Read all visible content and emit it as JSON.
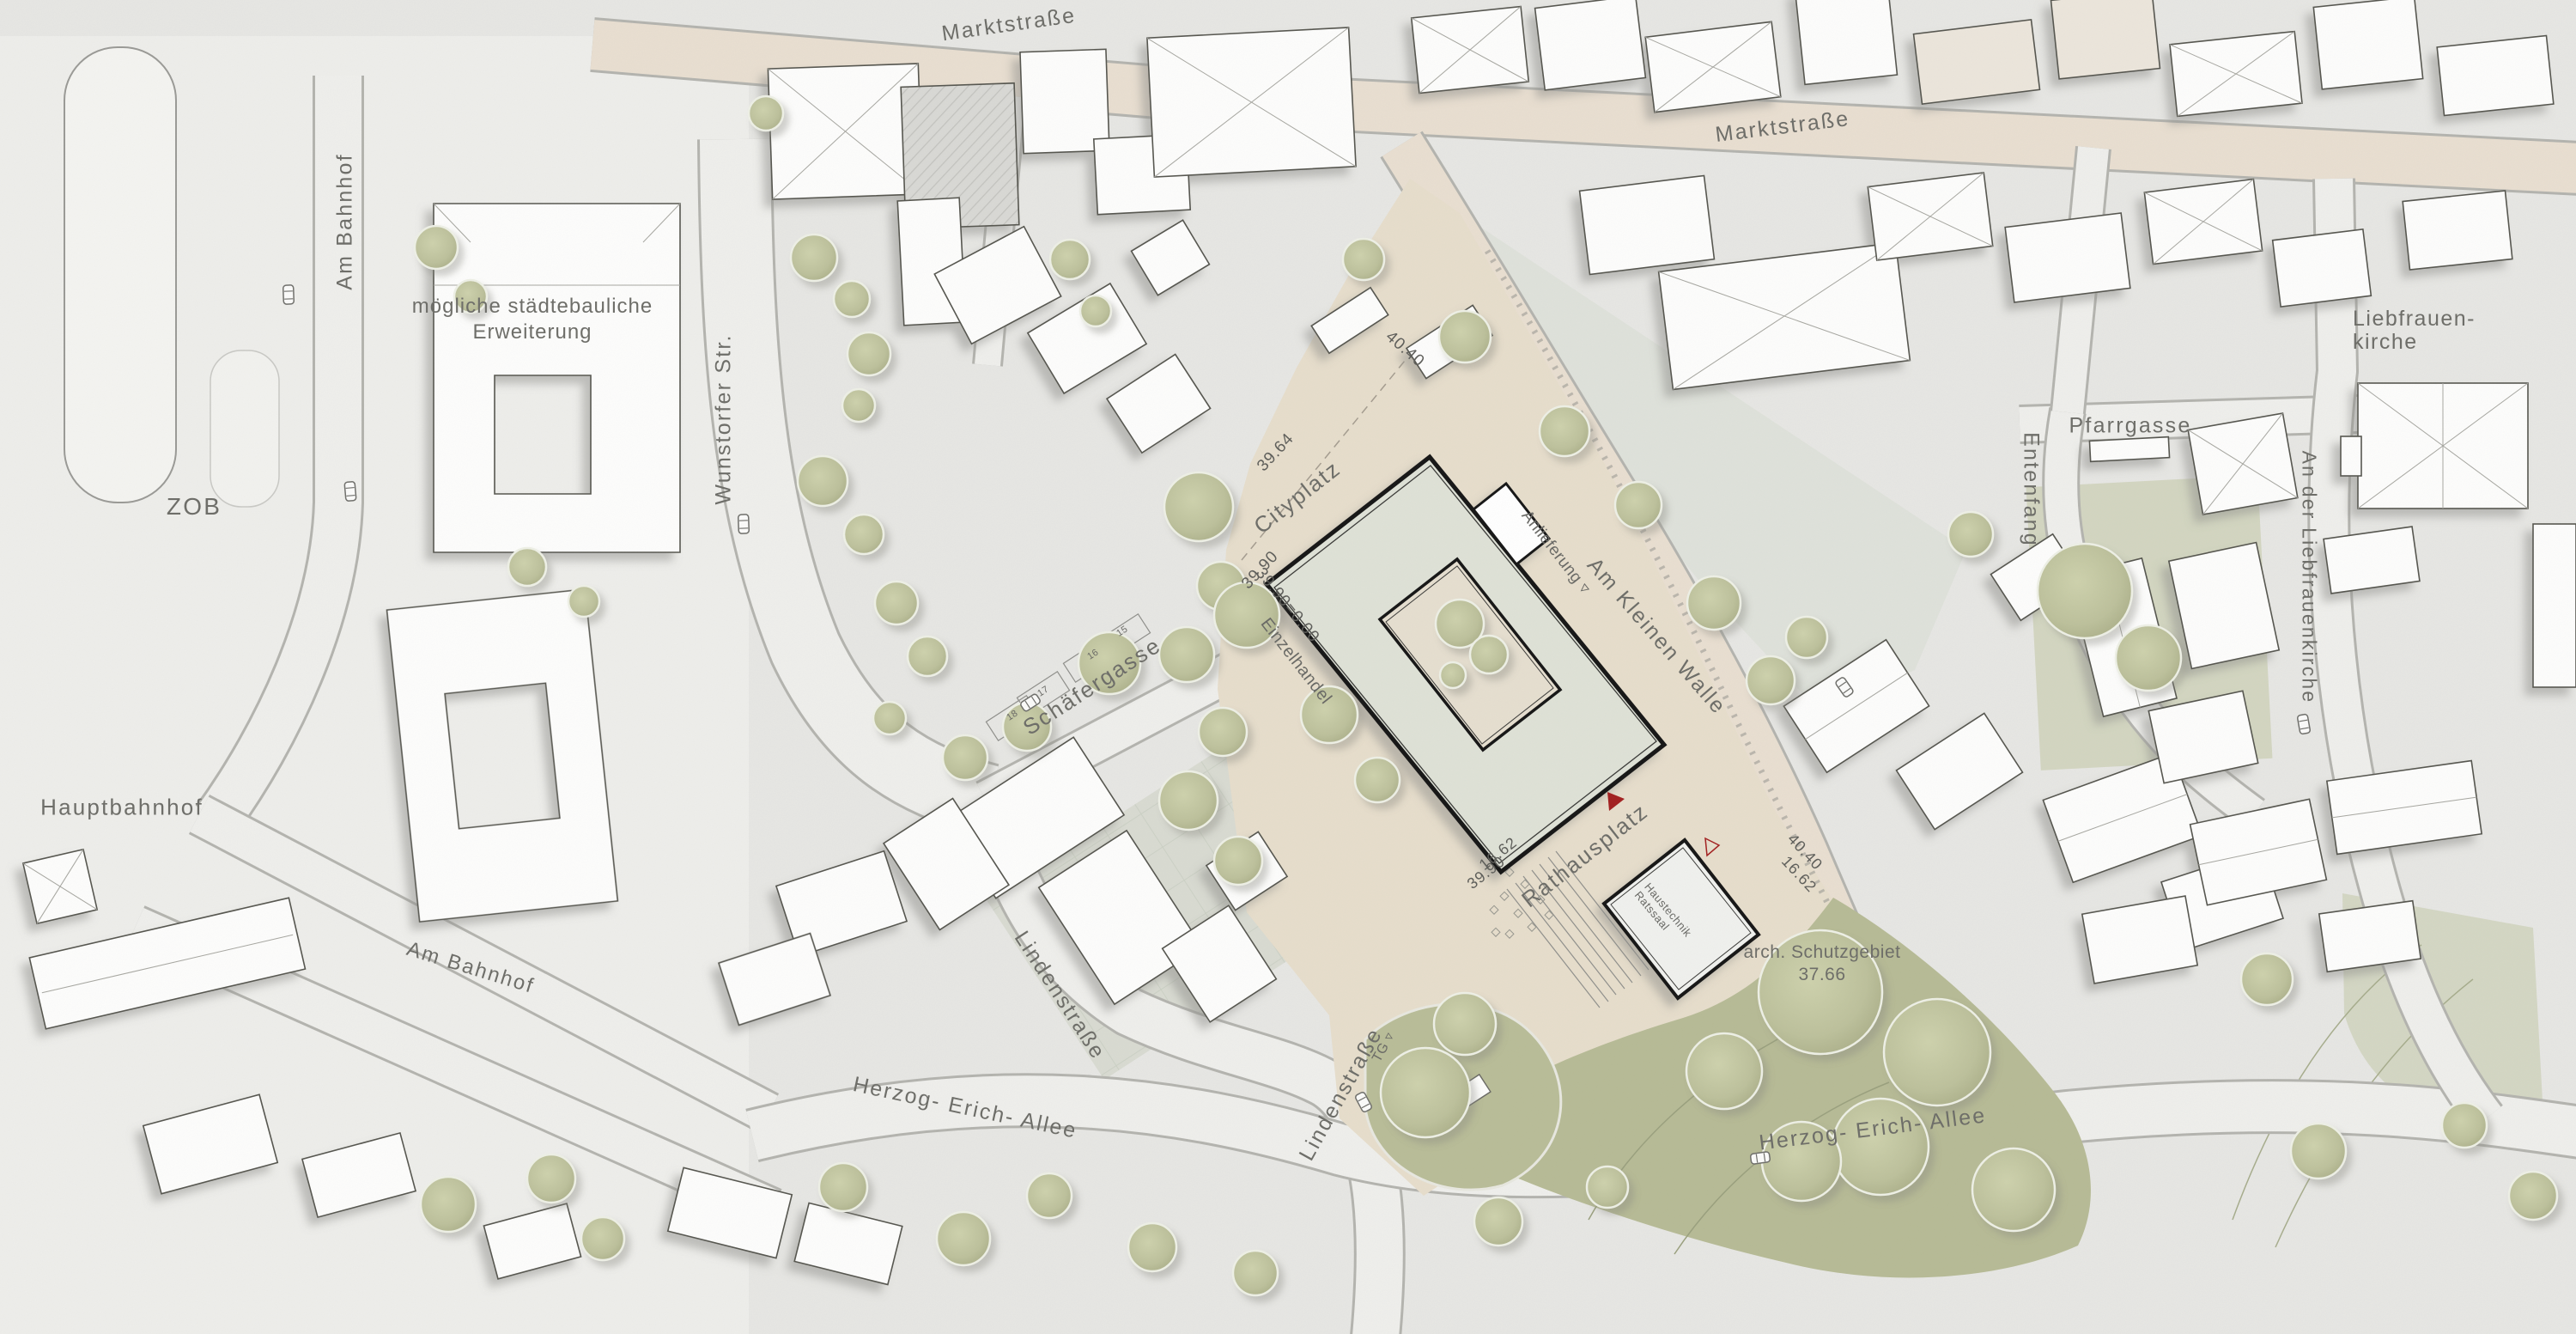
{
  "places": {
    "zob": "ZOB",
    "hauptbahnhof": "Hauptbahnhof",
    "cityplatz": "Cityplatz",
    "rathausplatz": "Rathausplatz",
    "liebfrauenkirche_line1": "Liebfrauen-",
    "liebfrauenkirche_line2": "kirche",
    "erweiterung_line1": "mögliche städtebauliche",
    "erweiterung_line2": "Erweiterung",
    "schutzgebiet_line1": "arch. Schutzgebiet",
    "schutzgebiet_line2": "37.66"
  },
  "streets": {
    "marktstrasse": "Marktstraße",
    "am_bahnhof": "Am Bahnhof",
    "wunstorfer": "Wunstorfer Str.",
    "schaefergasse": "Schäfergasse",
    "lindenstrasse": "Lindenstraße",
    "herzog_erich_allee": "Herzog- Erich- Allee",
    "am_kleinen_walle": "Am Kleinen Walle",
    "pfarrgasse": "Pfarrgasse",
    "entenfang": "Entenfang",
    "an_der_liebfrauenkirche": "An der Liebfrauenkirche"
  },
  "building_text": {
    "einzelhandel": "Einzelhandel",
    "anlieferung": "Anlieferung ▿",
    "haustechnik": "Haustechnik",
    "ratssaal": "Ratssaal",
    "tiefgarage": "TG ▿"
  },
  "elevations": {
    "cityplatz_39_64": "39.64",
    "cityplatz_39_90": "39.90",
    "ground_zero": "39.90=0.00",
    "walle_40_40": "40.40",
    "hall_16_62_sw": "16.62",
    "hall_39_90_sw": "39.90",
    "walle_40_40_se": "40.40",
    "hall_16_62_se": "16.62"
  },
  "parking": {
    "stall_15": "15",
    "stall_16": "16",
    "stall_17": "17",
    "stall_18": "18"
  },
  "colors": {
    "paper": "#e9e9e6",
    "street_beige": "#e9dfd1",
    "plaza_beige": "#e7decc",
    "building_outline": "#161616",
    "tree_green": "#bcc09b",
    "park_green": "#b7bb96",
    "marker_red": "#a32020"
  }
}
